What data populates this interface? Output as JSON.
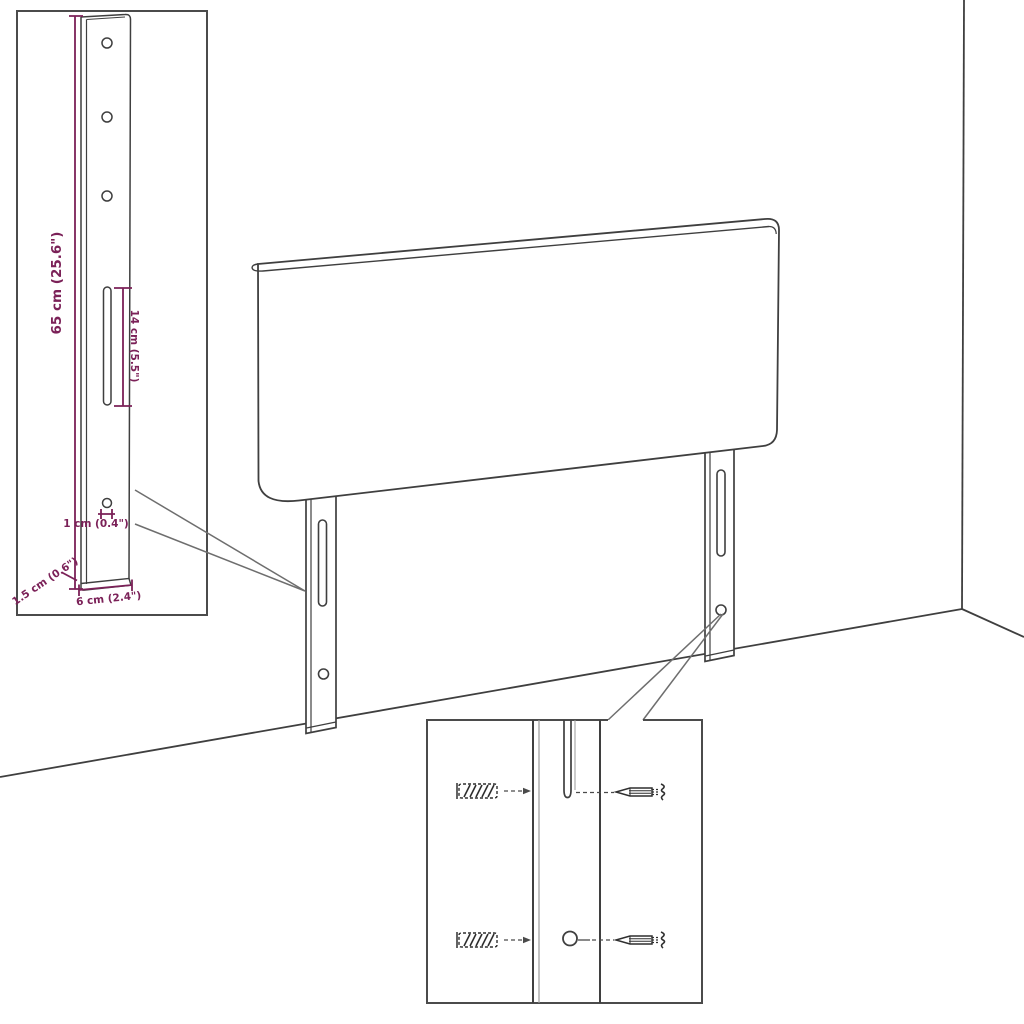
{
  "meta": {
    "description": "Technical dimension diagram of an upholstered headboard with two mounting legs, shown against a wall corner and floor line. A left inset magnifies one leg with its measurements; a bottom inset magnifies the wall-fixing point with wall plugs and screws."
  },
  "colors": {
    "background": "#ffffff",
    "outline": "#3f3f3f",
    "inset_border": "#4b4b4b",
    "dimension_accent": "#7b2158",
    "light_line": "#9a9a9a",
    "callout_line": "#6e6e6e"
  },
  "leg_detail_inset": {
    "dimensions": {
      "height": "65 cm (25.6\")",
      "slot_length": "14 cm (5.5\")",
      "hole_diameter": "1 cm (0.4\")",
      "depth": "1.5 cm (0.6\")",
      "width": "6 cm (2.4\")"
    },
    "features": [
      "screw-hole-top",
      "screw-hole-middle",
      "screw-hole-lower",
      "adjustment-slot",
      "bottom-hole"
    ]
  },
  "mounting_detail_inset": {
    "hardware": [
      "wall-plug",
      "screw"
    ],
    "rows": [
      {
        "left": "wall-plug",
        "target": "adjustment-slot",
        "right": "screw"
      },
      {
        "left": "wall-plug",
        "target": "fixing-hole",
        "right": "screw"
      }
    ]
  },
  "scene": {
    "elements": [
      "headboard-panel",
      "left-mounting-leg",
      "right-mounting-leg",
      "wall-corner",
      "floor-line"
    ]
  }
}
